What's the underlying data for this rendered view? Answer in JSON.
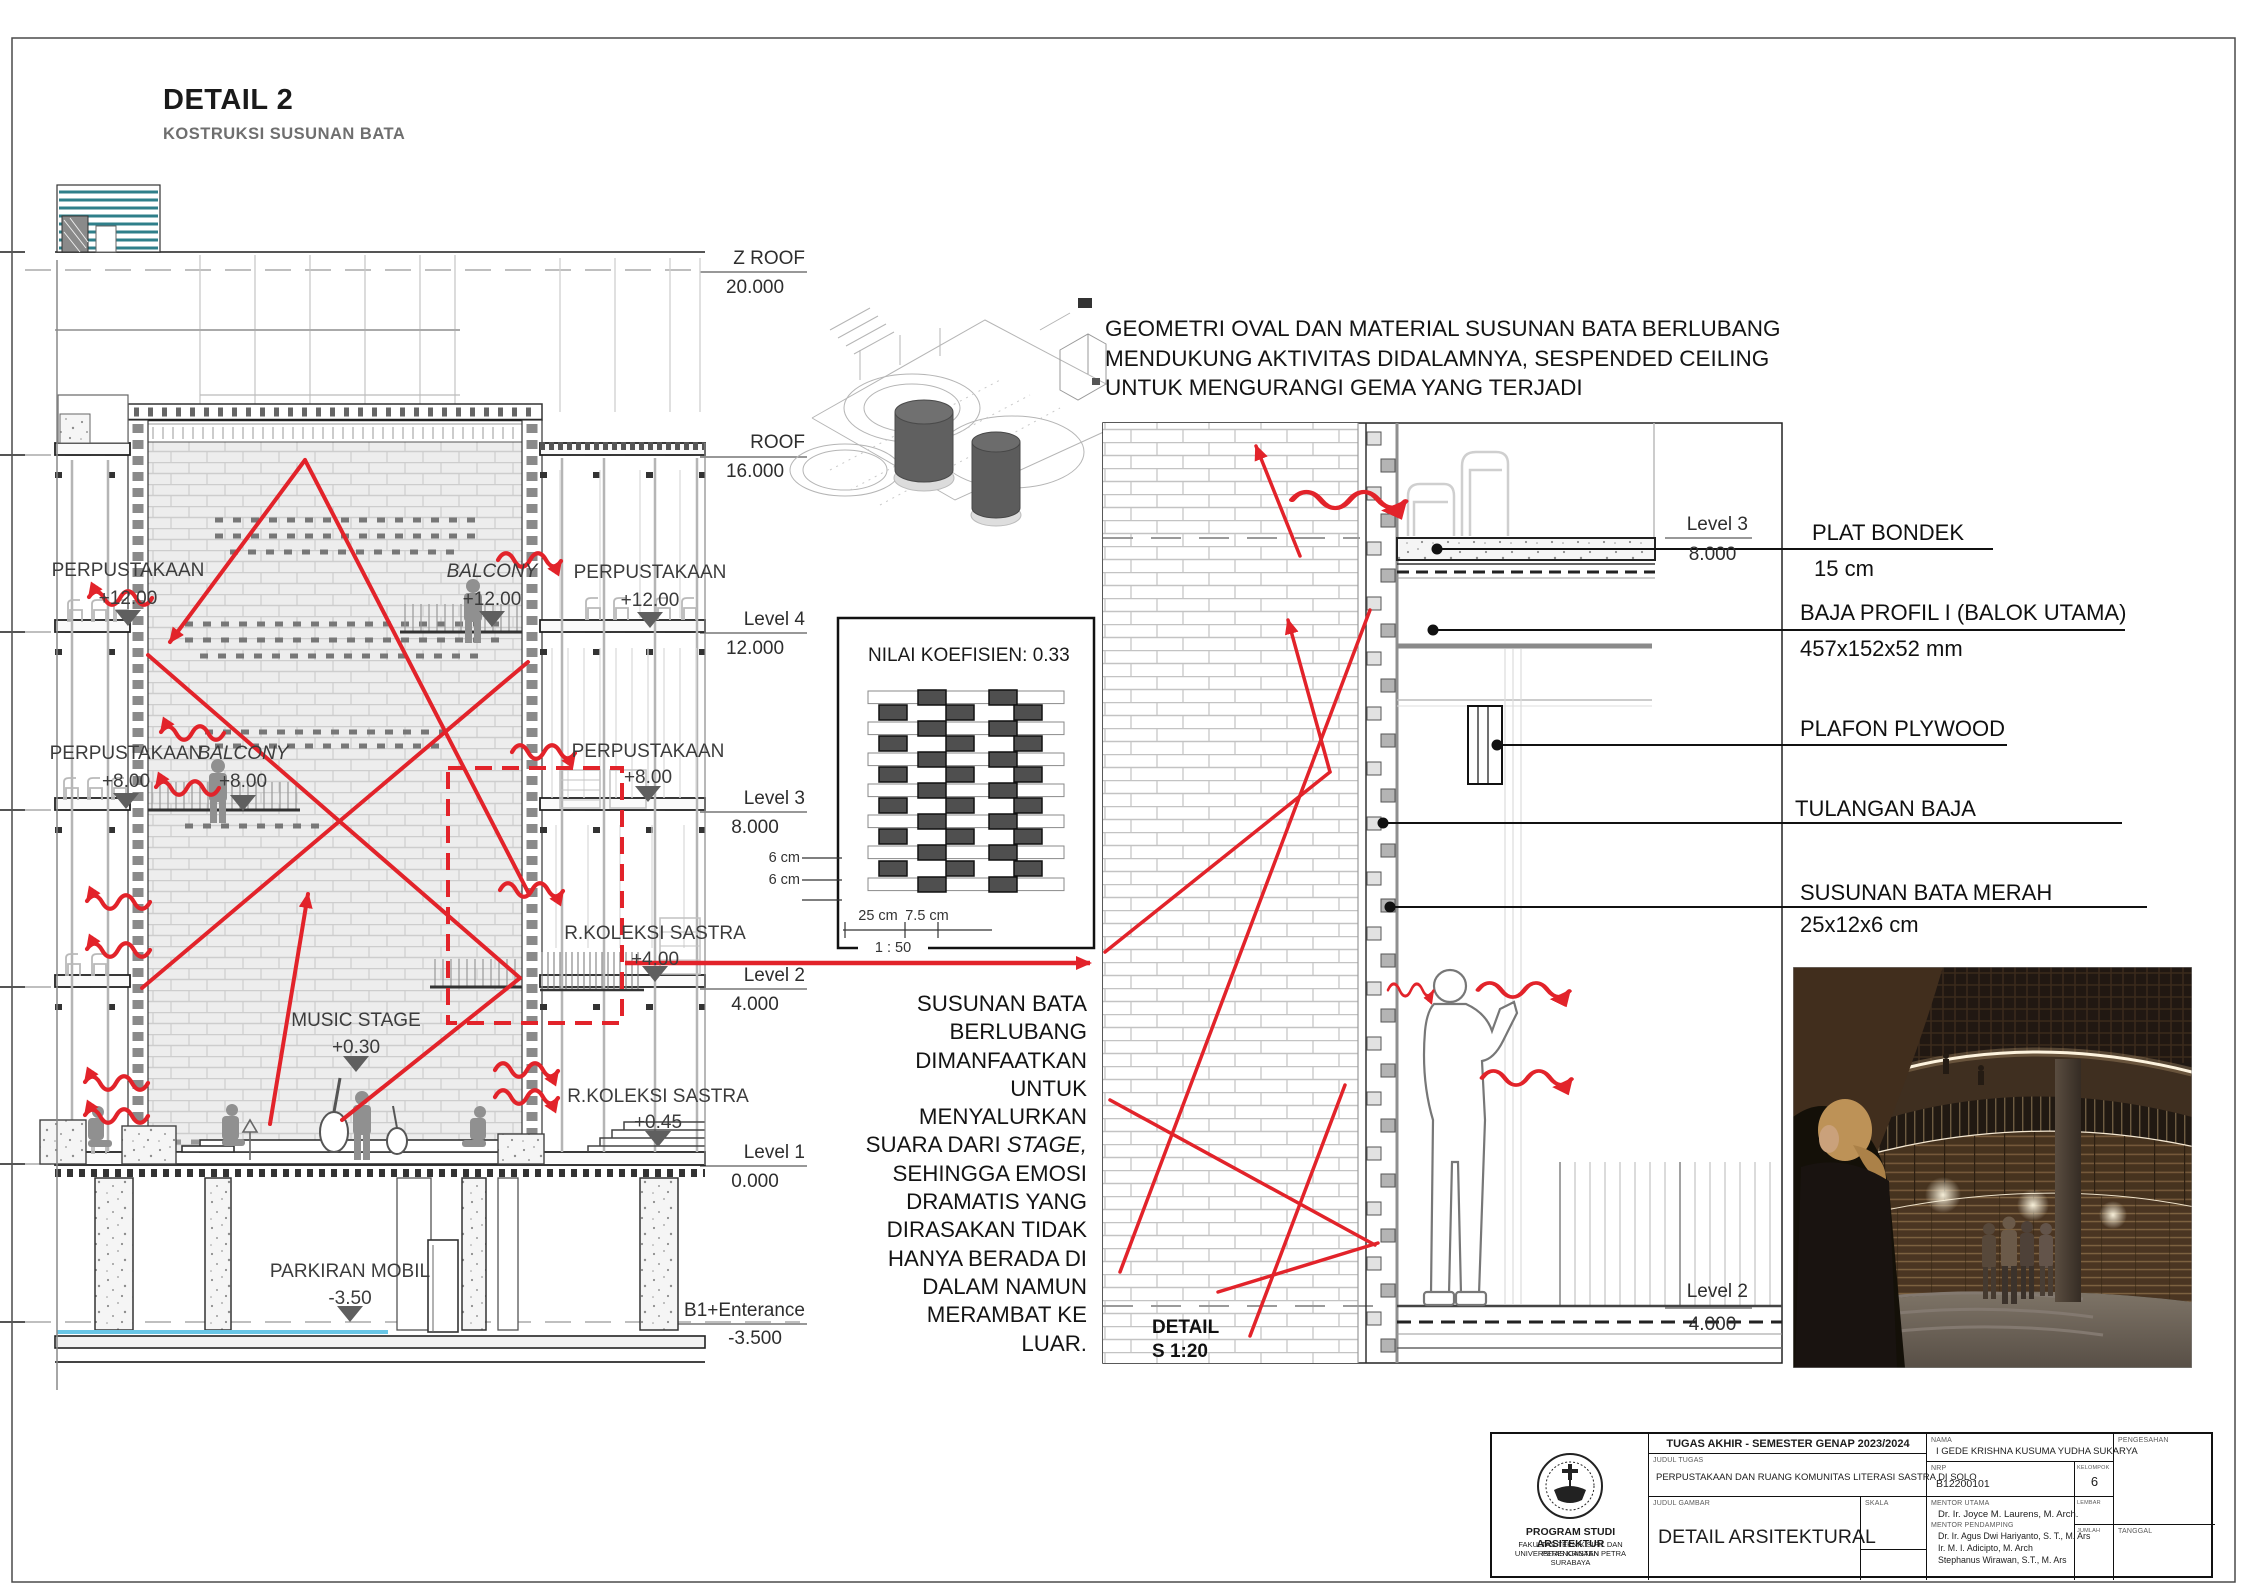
{
  "sheet": {
    "title": "DETAIL 2",
    "subtitle": "KOSTRUKSI SUSUNAN BATA"
  },
  "colors": {
    "accent_red": "#e2232a",
    "teal_stripe": "#2f7f8a",
    "water_blue": "#69c6e6",
    "dark": "#1a1a1a"
  },
  "section": {
    "levels": [
      {
        "name": "Z ROOF",
        "elev": "20.000"
      },
      {
        "name": "ROOF",
        "elev": "16.000"
      },
      {
        "name": "Level 4",
        "elev": "12.000"
      },
      {
        "name": "Level 3",
        "elev": "8.000"
      },
      {
        "name": "Level 2",
        "elev": "4.000"
      },
      {
        "name": "Level 1",
        "elev": "0.000"
      },
      {
        "name": "B1+Enterance",
        "elev": "-3.500"
      }
    ],
    "rooms": [
      {
        "label": "PERPUSTAKAAN",
        "elev": "+12.00"
      },
      {
        "label": "BALCONY",
        "elev": "+12.00"
      },
      {
        "label": "PERPUSTAKAAN",
        "elev": "+12.00"
      },
      {
        "label": "PERPUSTAKAAN",
        "elev": "+8.00"
      },
      {
        "label": "BALCONY",
        "elev": "+8.00"
      },
      {
        "label": "PERPUSTAKAAN",
        "elev": "+8.00"
      },
      {
        "label": "R.KOLEKSI SASTRA",
        "elev": "+4.00"
      },
      {
        "label": "MUSIC STAGE",
        "elev": "+0.30"
      },
      {
        "label": "R.KOLEKSI SASTRA",
        "elev": "+0.45"
      },
      {
        "label": "PARKIRAN MOBIL",
        "elev": "-3.50"
      }
    ]
  },
  "koefisien": {
    "title": "NILAI KOEFISIEN: 0.33",
    "dim_h1": "6 cm",
    "dim_h2": "6 cm",
    "dim_w": "25 cm",
    "dim_gap": "7.5 cm",
    "scale": "1 : 50"
  },
  "note_top": {
    "line1": "GEOMETRI OVAL DAN MATERIAL SUSUNAN BATA BERLUBANG",
    "line2": "MENDUKUNG AKTIVITAS DIDALAMNYA, SESPENDED CEILING",
    "line3": "UNTUK MENGURANGI GEMA YANG TERJADI"
  },
  "note_side": {
    "lines_before": [
      "SUSUNAN BATA",
      "BERLUBANG",
      "DIMANFAATKAN",
      "UNTUK",
      "MENYALURKAN"
    ],
    "line_prefix": "SUARA DARI ",
    "line_italic": "STAGE,",
    "lines_after": [
      "SEHINGGA EMOSI",
      "DRAMATIS YANG",
      "DIRASAKAN TIDAK",
      "HANYA BERADA DI",
      "DALAM NAMUN",
      "MERAMBAT KE",
      "LUAR."
    ]
  },
  "detail": {
    "title": "DETAIL",
    "scale": "S 1:20",
    "level3": {
      "name": "Level 3",
      "elev": "8.000"
    },
    "level2": {
      "name": "Level 2",
      "elev": "4.000"
    },
    "callouts": [
      {
        "label": "PLAT BONDEK",
        "sub": "15 cm"
      },
      {
        "label": "BAJA PROFIL I (BALOK UTAMA)",
        "sub": "457x152x52 mm"
      },
      {
        "label": "PLAFON PLYWOOD",
        "sub": ""
      },
      {
        "label": "TULANGAN BAJA",
        "sub": ""
      },
      {
        "label": "SUSUNAN BATA MERAH",
        "sub": "25x12x6 cm"
      }
    ]
  },
  "titleblock": {
    "program": "PROGRAM STUDI ARSITEKTUR",
    "faculty": "FAKULTAS TEKNIK SIPIL DAN PERENCANAAN",
    "university": "UNIVERSITAS KRISTEN PETRA",
    "city": "SURABAYA",
    "header": "TUGAS AKHIR - SEMESTER GENAP 2023/2024",
    "judul_tugas_label": "JUDUL TUGAS",
    "judul_tugas": "PERPUSTAKAAN DAN RUANG KOMUNITAS LITERASI SASTRA DI SOLO",
    "judul_gambar_label": "JUDUL GAMBAR",
    "judul_gambar": "DETAIL ARSITEKTURAL",
    "skala_label": "SKALA",
    "nama_label": "NAMA",
    "nama": "I GEDE KRISHNA KUSUMA YUDHA SUKARYA",
    "nrp_label": "NRP",
    "nrp": "B12200101",
    "kelompok_label": "KELOMPOK",
    "kelompok": "6",
    "mentor_utama_label": "MENTOR UTAMA",
    "mentor_utama": "Dr. Ir. Joyce M. Laurens, M. Arch.",
    "mentor_pendamping_label": "MENTOR PENDAMPING",
    "mentor_pendamping": [
      "Dr. Ir. Agus Dwi Hariyanto, S. T., M. Ars",
      "Ir. M. I. Adicipto, M. Arch",
      "Stephanus Wirawan, S.T., M. Ars"
    ],
    "lembar_label": "LEMBAR",
    "jumlah_label": "JUMLAH",
    "pengesahan_label": "PENGESAHAN",
    "tanggal_label": "TANGGAL"
  }
}
